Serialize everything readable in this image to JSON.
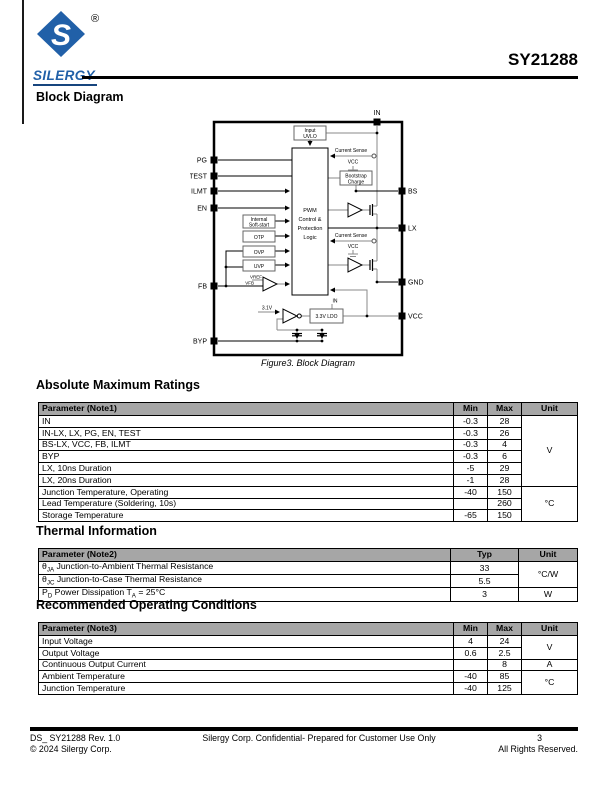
{
  "header": {
    "brand": "SILERGY",
    "registered": "®",
    "logo_letter": "S",
    "part_number": "SY21288"
  },
  "sections": {
    "block_diagram": "Block Diagram",
    "abs_max": "Absolute Maximum Ratings",
    "thermal": "Thermal Information",
    "rec_op": "Recommended Operating Conditions"
  },
  "diagram": {
    "caption": "Figure3. Block Diagram",
    "pins": {
      "in": "IN",
      "pg": "PG",
      "test": "TEST",
      "ilmt": "ILMT",
      "en": "EN",
      "fb": "FB",
      "byp": "BYP",
      "bs": "BS",
      "lx": "LX",
      "gnd": "GND",
      "vcc": "VCC"
    },
    "labels": {
      "uvlo1": "Input",
      "uvlo2": "UVLO",
      "pwm1": "PWM",
      "pwm2": "Control &",
      "pwm3": "Protection",
      "pwm4": "Logic",
      "cs_top": "Current Sense",
      "cs_bot": "Current Sense",
      "vcc_top": "VCC",
      "vcc_bot": "VCC",
      "boot1": "Bootstrap",
      "boot2": "Charge",
      "ss1": "Internal",
      "ss2": "Soft-start",
      "otp": "OTP",
      "ovp": "OVP",
      "uvp": "UVP",
      "vref": "VREF",
      "vfb": "VFB",
      "v31": "3.1V",
      "ldo_in": "IN",
      "ldo": "3.3V LDO"
    }
  },
  "tables": {
    "abs_max": {
      "headers": [
        "Parameter (Note1)",
        "Min",
        "Max",
        "Unit"
      ],
      "col_widths": [
        415,
        34,
        34,
        56
      ],
      "rows": [
        [
          "IN",
          "-0.3",
          "28",
          {
            "text": "V",
            "rowspan": 6
          }
        ],
        [
          "IN-LX, LX, PG, EN, TEST",
          "-0.3",
          "26"
        ],
        [
          "BS-LX, VCC, FB, ILMT",
          "-0.3",
          "4"
        ],
        [
          "BYP",
          "-0.3",
          "6"
        ],
        [
          "LX, 10ns Duration",
          "-5",
          "29"
        ],
        [
          "LX, 20ns Duration",
          "-1",
          "28"
        ],
        [
          "Junction Temperature, Operating",
          "-40",
          "150",
          {
            "text": "°C",
            "rowspan": 3
          }
        ],
        [
          "Lead Temperature (Soldering, 10s)",
          "",
          "260"
        ],
        [
          "Storage Temperature",
          "-65",
          "150"
        ]
      ]
    },
    "thermal": {
      "headers": [
        "Parameter (Note2)",
        "Typ",
        "Unit"
      ],
      "col_widths": [
        412,
        68,
        59
      ],
      "rows": [
        [
          "θ~JA~ Junction-to-Ambient Thermal Resistance",
          "33",
          {
            "text": "°C/W",
            "rowspan": 2
          }
        ],
        [
          "θ~JC~ Junction-to-Case Thermal Resistance",
          "5.5"
        ],
        [
          "P~D~ Power Dissipation T~A~ = 25°C",
          "3",
          "W"
        ]
      ]
    },
    "rec_op": {
      "headers": [
        "Parameter (Note3)",
        "Min",
        "Max",
        "Unit"
      ],
      "col_widths": [
        415,
        34,
        34,
        56
      ],
      "rows": [
        [
          "Input Voltage",
          "4",
          "24",
          {
            "text": "V",
            "rowspan": 2
          }
        ],
        [
          "Output Voltage",
          "0.6",
          "2.5"
        ],
        [
          "Continuous Output Current",
          "",
          "8",
          "A"
        ],
        [
          "Ambient Temperature",
          "-40",
          "85",
          {
            "text": "°C",
            "rowspan": 2
          }
        ],
        [
          "Junction Temperature",
          "-40",
          "125"
        ]
      ]
    }
  },
  "footer": {
    "doc_id": "DS_ SY21288 Rev. 1.0",
    "copyright": "© 2024 Silergy Corp.",
    "confidential": "Silergy Corp. Confidential- Prepared for Customer Use Only",
    "page_number": "3",
    "rights": "All Rights Reserved."
  },
  "colors": {
    "brand_blue": "#2160a8",
    "table_header_bg": "#a6a6a6",
    "wire_gray": "#8a8a8a"
  }
}
